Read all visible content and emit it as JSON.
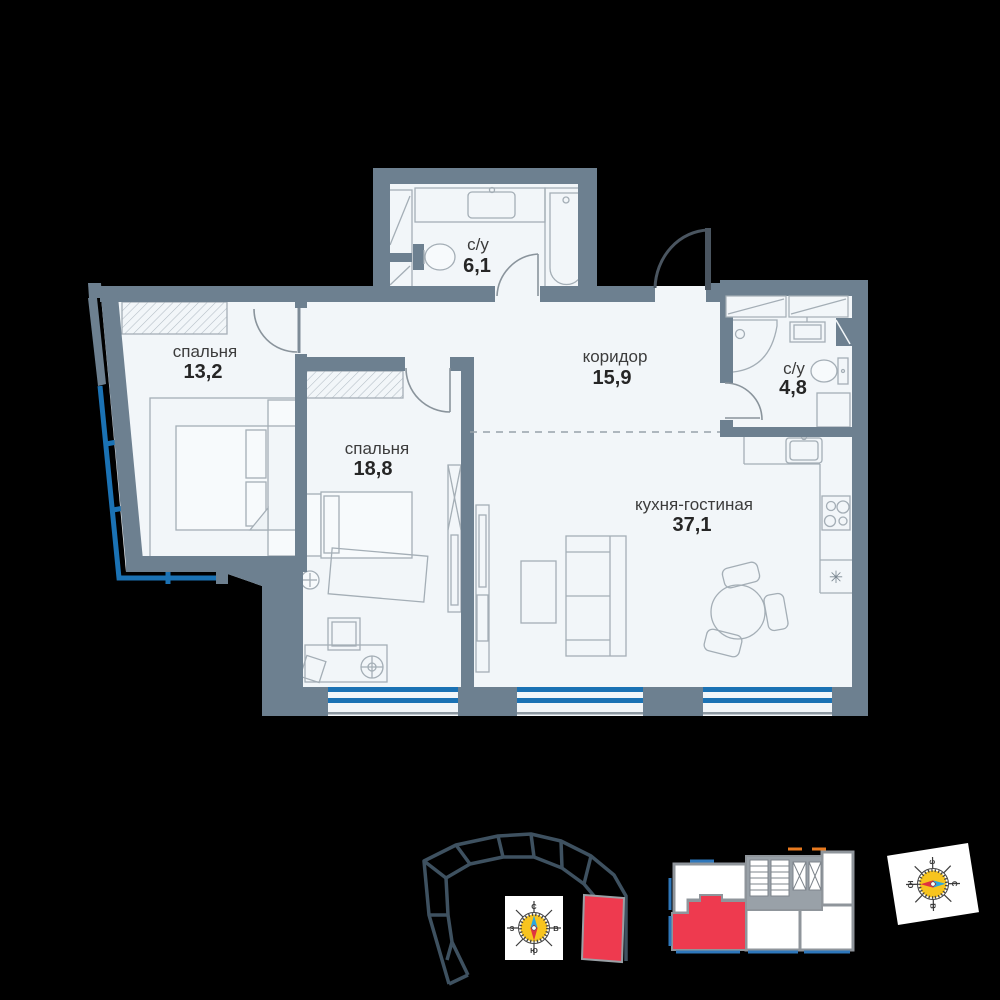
{
  "rooms": {
    "bedroom_small": {
      "name": "спальня",
      "area": "13,2"
    },
    "bedroom_large": {
      "name": "спальня",
      "area": "18,8"
    },
    "bathroom_top": {
      "name": "с/у",
      "area": "6,1"
    },
    "corridor": {
      "name": "коридор",
      "area": "15,9"
    },
    "bathroom_right": {
      "name": "с/у",
      "area": "4,8"
    },
    "kitchen_living": {
      "name": "кухня-гостиная",
      "area": "37,1"
    }
  },
  "symbols": {
    "appliance": "✳"
  },
  "compass": {
    "north": "С",
    "east": "В",
    "south": "Ю",
    "west": "З"
  },
  "colors": {
    "wall": "#6d8090",
    "room_fill": "#f2f6f9",
    "furniture_stroke": "#a4aeb6",
    "window_blue": "#1b72b4",
    "unit_red": "#ee3a4f",
    "building_outline": "#3e5160",
    "floorplate_wall": "#8f959b",
    "compass_yellow": "#f7c41e",
    "needle_blue": "#2ba8e0",
    "needle_red": "#e03240",
    "accent_orange": "#e87a1f"
  }
}
